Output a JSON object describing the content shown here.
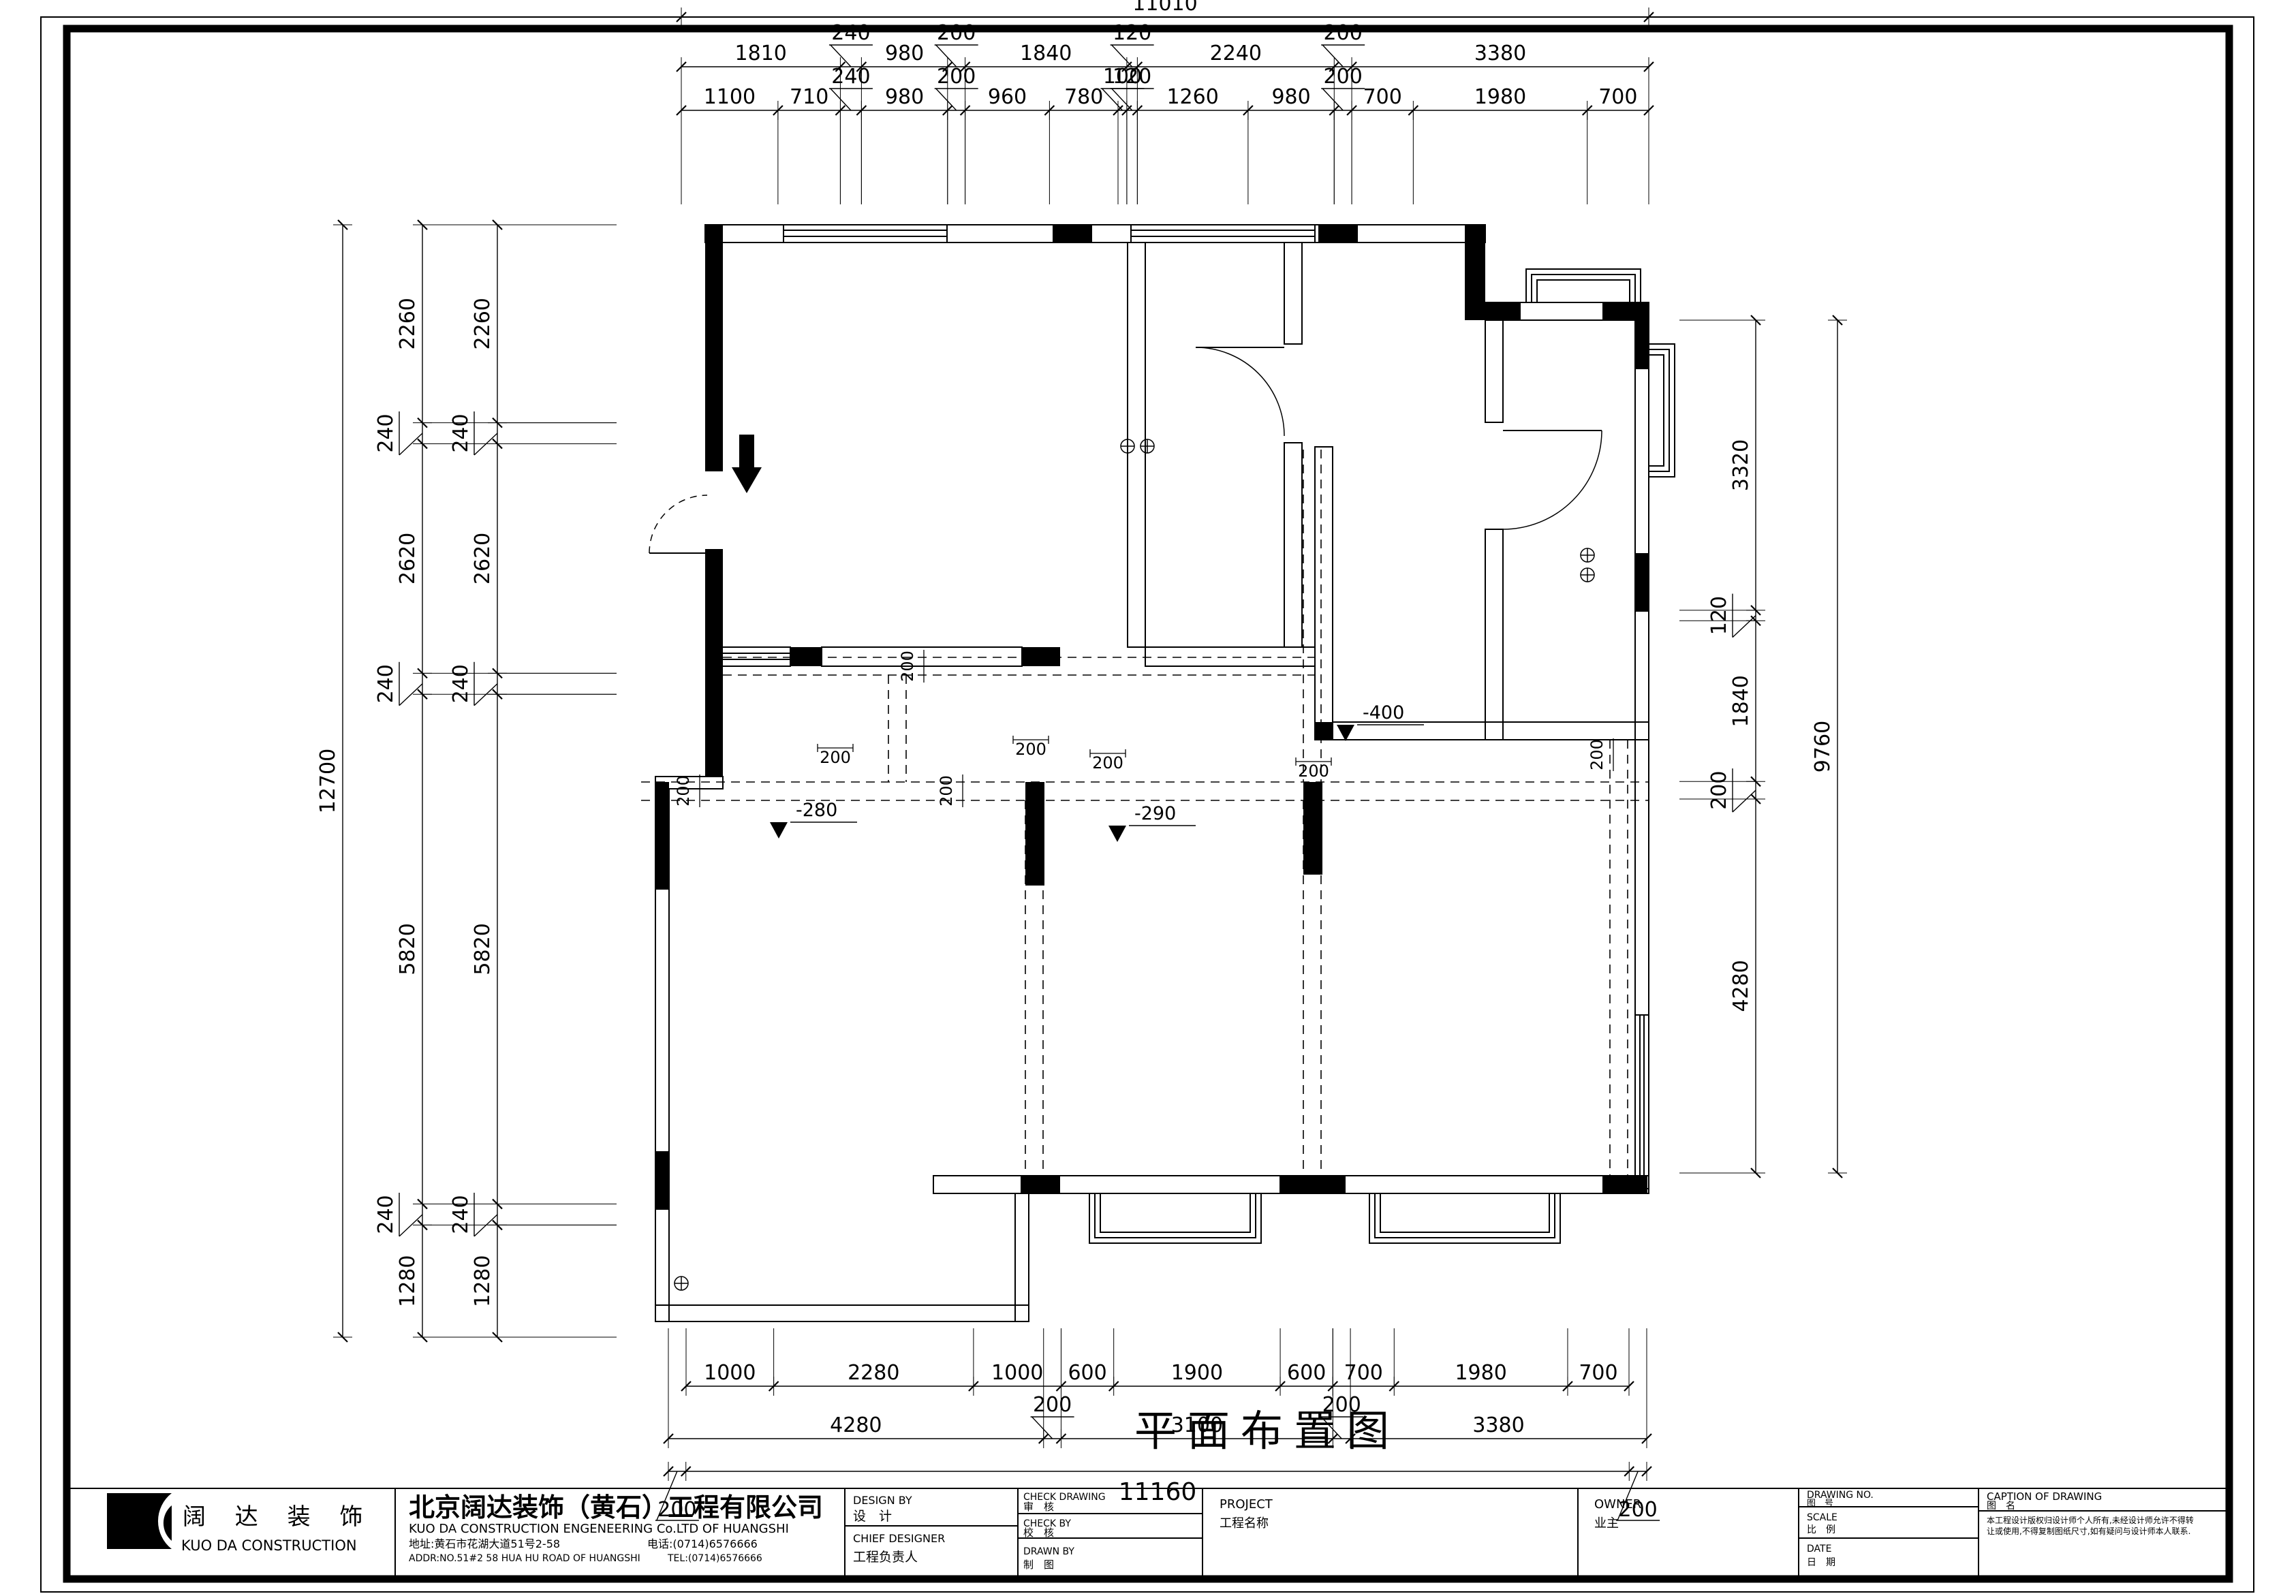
{
  "sheet": {
    "title": "平面布置图"
  },
  "dims": {
    "top_overall": {
      "values": [
        11010
      ]
    },
    "top_row1": {
      "values": [
        1810,
        240,
        980,
        200,
        1840,
        120,
        2240,
        200,
        3380
      ]
    },
    "top_row2": {
      "values": [
        1100,
        710,
        240,
        980,
        200,
        960,
        780,
        100,
        120,
        1260,
        980,
        200,
        700,
        1980,
        700
      ]
    },
    "left_overall": {
      "values": [
        12700
      ]
    },
    "left_inner": {
      "values": [
        2260,
        240,
        2620,
        240,
        5820,
        240,
        1280
      ]
    },
    "left_outer": {
      "values": [
        2260,
        240,
        2620,
        240,
        5820,
        240,
        1280
      ]
    },
    "right_inner": {
      "values": [
        3320,
        120,
        1840,
        200,
        4280
      ]
    },
    "right_overall": {
      "values": [
        9760
      ]
    },
    "bottom_row1": {
      "values": [
        1000,
        2280,
        1000,
        600,
        1900,
        600,
        700,
        1980,
        700
      ]
    },
    "bottom_row2": {
      "values": [
        4280,
        200,
        3100,
        200,
        3380
      ]
    },
    "bottom_row3": {
      "values": [
        200,
        11160,
        200
      ]
    }
  },
  "annotations": {
    "beam_label": "200",
    "levels": [
      "-280",
      "-290",
      "-400"
    ]
  },
  "titleblock": {
    "logo": {
      "cn": "阔 达 装 饰",
      "en": "KUO DA CONSTRUCTION"
    },
    "company": "北京阔达装饰（黄石）工程有限公司",
    "company_en": "KUO DA CONSTRUCTION ENGENEERING Co.LTD OF HUANGSHI",
    "address": "地址:黄石市花湖大道51号2-58",
    "phone": "电话:(0714)6576666",
    "address_en": "ADDR:NO.51#2 58 HUA HU ROAD OF HUANGSHI",
    "tel_en": "TEL:(0714)6576666",
    "fields": {
      "design_by_en": "DESIGN BY",
      "design_by": "设　计",
      "chief_designer_en": "CHIEF DESIGNER",
      "chief_designer": "工程负责人",
      "check_drawing_en": "CHECK DRAWING",
      "check_drawing": "审　核",
      "check_by_en": "CHECK BY",
      "check_by": "校　核",
      "drawn_by_en": "DRAWN BY",
      "drawn_by": "制　图",
      "project_en": "PROJECT",
      "project": "工程名称",
      "owner_en": "OWNER",
      "owner": "业主",
      "drawing_no_en": "DRAWING NO.",
      "drawing_no": "图　号",
      "scale_en": "SCALE",
      "scale": "比　例",
      "date_en": "DATE",
      "date": "日　期",
      "caption_en": "CAPTION OF DRAWING",
      "caption": "图　名",
      "note1": "本工程设计版权归设计师个人所有,未经设计师允许不得转",
      "note2": "让或使用,不得复制图纸尺寸,如有疑问与设计师本人联系."
    }
  }
}
